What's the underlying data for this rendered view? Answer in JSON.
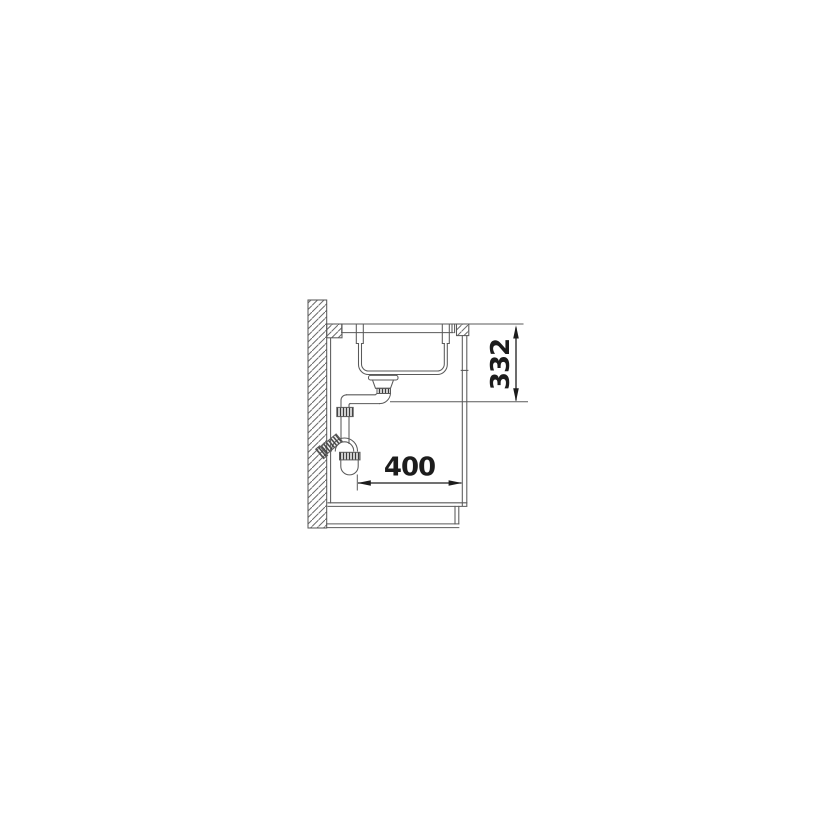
{
  "figure": {
    "kind": "sink-installation-side-section"
  },
  "dimensions": {
    "vertical_mm": "332",
    "horizontal_mm": "400"
  },
  "colors": {
    "background": "#ffffff",
    "line": "#5a5a5a",
    "dimension": "#1c1c1c"
  }
}
